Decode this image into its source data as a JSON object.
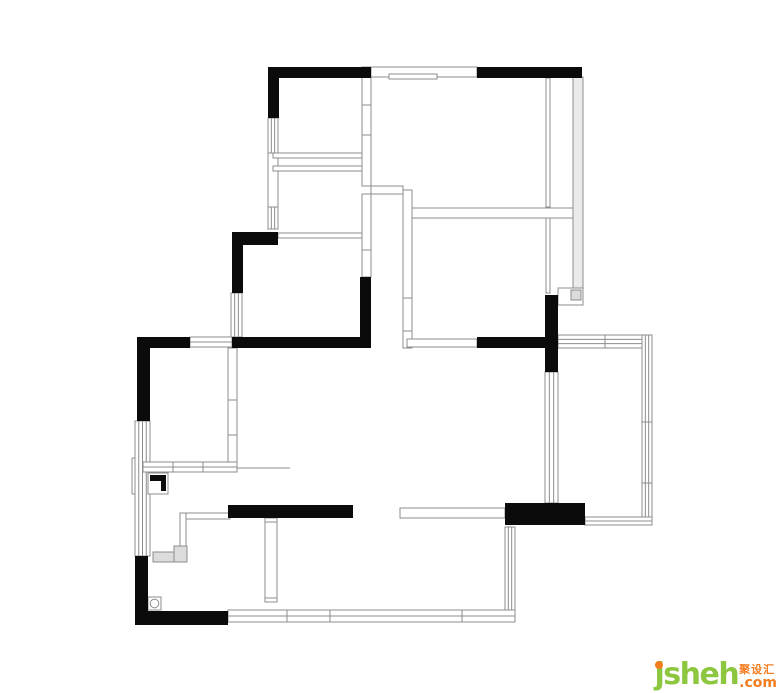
{
  "page": {
    "background": "#ffffff"
  },
  "logo": {
    "brand": "jsheh",
    "cn_label": "聚设汇",
    "tld": ".com",
    "green": "#8dc63f",
    "orange": "#f47d20"
  },
  "floor_plan": {
    "stroke": "#8c8c8c",
    "wall_fill": "#0b0b0b",
    "glass_fill": "#ebebeb",
    "hatch_fill": "#dcdcdc",
    "solid_walls": [
      {
        "x": 268,
        "y": 67,
        "w": 103,
        "h": 11
      },
      {
        "x": 268,
        "y": 67,
        "w": 11,
        "h": 51
      },
      {
        "x": 477,
        "y": 67,
        "w": 105,
        "h": 11
      },
      {
        "x": 232,
        "y": 232,
        "w": 46,
        "h": 13
      },
      {
        "x": 232,
        "y": 232,
        "w": 11,
        "h": 61
      },
      {
        "x": 360,
        "y": 277,
        "w": 11,
        "h": 71
      },
      {
        "x": 232,
        "y": 337,
        "w": 139,
        "h": 11
      },
      {
        "x": 477,
        "y": 337,
        "w": 68,
        "h": 11
      },
      {
        "x": 545,
        "y": 295,
        "w": 13,
        "h": 77
      },
      {
        "x": 137,
        "y": 337,
        "w": 53,
        "h": 11
      },
      {
        "x": 137,
        "y": 337,
        "w": 13,
        "h": 84
      },
      {
        "x": 135,
        "y": 556,
        "w": 13,
        "h": 69
      },
      {
        "x": 135,
        "y": 611,
        "w": 93,
        "h": 14
      },
      {
        "x": 228,
        "y": 505,
        "w": 125,
        "h": 13
      },
      {
        "x": 505,
        "y": 503,
        "w": 80,
        "h": 22
      }
    ],
    "thin_rects": [
      {
        "x": 371,
        "y": 67,
        "w": 106,
        "h": 10
      },
      {
        "x": 389,
        "y": 74,
        "w": 48,
        "h": 5
      },
      {
        "x": 268,
        "y": 153,
        "w": 10,
        "h": 55
      },
      {
        "x": 273,
        "y": 153,
        "w": 92,
        "h": 5
      },
      {
        "x": 273,
        "y": 166,
        "w": 92,
        "h": 5
      },
      {
        "x": 362,
        "y": 67,
        "w": 9,
        "h": 119
      },
      {
        "x": 371,
        "y": 186,
        "w": 32,
        "h": 8
      },
      {
        "x": 362,
        "y": 194,
        "w": 9,
        "h": 83
      },
      {
        "x": 278,
        "y": 233,
        "w": 84,
        "h": 5
      },
      {
        "x": 403,
        "y": 190,
        "w": 9,
        "h": 158
      },
      {
        "x": 412,
        "y": 208,
        "w": 171,
        "h": 10
      },
      {
        "x": 546,
        "y": 78,
        "w": 4,
        "h": 129
      },
      {
        "x": 546,
        "y": 218,
        "w": 4,
        "h": 75
      },
      {
        "x": 573,
        "y": 77,
        "w": 10,
        "h": 218,
        "fill": "glass"
      },
      {
        "x": 558,
        "y": 288,
        "w": 25,
        "h": 17
      },
      {
        "x": 407,
        "y": 339,
        "w": 70,
        "h": 8
      },
      {
        "x": 400,
        "y": 508,
        "w": 105,
        "h": 10
      },
      {
        "x": 228,
        "y": 348,
        "w": 9,
        "h": 124
      },
      {
        "x": 265,
        "y": 518,
        "w": 12,
        "h": 84
      },
      {
        "x": 180,
        "y": 513,
        "w": 50,
        "h": 6
      },
      {
        "x": 180,
        "y": 513,
        "w": 6,
        "h": 43
      },
      {
        "x": 132,
        "y": 458,
        "w": 16,
        "h": 36
      }
    ],
    "window_bands": [
      {
        "x": 268,
        "y": 118,
        "w": 10,
        "h": 35,
        "orient": "v",
        "inner": 2,
        "ticks": []
      },
      {
        "x": 268,
        "y": 207,
        "w": 10,
        "h": 22,
        "orient": "v",
        "inner": 2,
        "ticks": []
      },
      {
        "x": 231,
        "y": 293,
        "w": 11,
        "h": 44,
        "orient": "v",
        "inner": 2,
        "ticks": []
      },
      {
        "x": 190,
        "y": 337,
        "w": 42,
        "h": 10,
        "orient": "h",
        "inner": 1,
        "ticks": []
      },
      {
        "x": 135,
        "y": 421,
        "w": 15,
        "h": 135,
        "orient": "v",
        "inner": 3,
        "ticks": []
      },
      {
        "x": 143,
        "y": 462,
        "w": 94,
        "h": 10,
        "orient": "h",
        "inner": 1,
        "ticks": [
          173,
          203
        ]
      },
      {
        "x": 545,
        "y": 372,
        "w": 13,
        "h": 131,
        "orient": "v",
        "inner": 2,
        "ticks": []
      },
      {
        "x": 558,
        "y": 335,
        "w": 94,
        "h": 13,
        "orient": "h",
        "inner": 2,
        "ticks": [
          605
        ]
      },
      {
        "x": 642,
        "y": 335,
        "w": 10,
        "h": 190,
        "orient": "v",
        "inner": 2,
        "ticks": [
          422,
          483
        ]
      },
      {
        "x": 585,
        "y": 517,
        "w": 67,
        "h": 8,
        "orient": "h",
        "inner": 1,
        "ticks": []
      },
      {
        "x": 505,
        "y": 527,
        "w": 10,
        "h": 93,
        "orient": "v",
        "inner": 2,
        "ticks": []
      },
      {
        "x": 228,
        "y": 610,
        "w": 287,
        "h": 12,
        "orient": "h",
        "inner": 1,
        "ticks": [
          287,
          330,
          462
        ]
      }
    ],
    "lines": [
      {
        "x1": 362,
        "y1": 105,
        "x2": 371,
        "y2": 105
      },
      {
        "x1": 362,
        "y1": 135,
        "x2": 371,
        "y2": 135
      },
      {
        "x1": 362,
        "y1": 250,
        "x2": 371,
        "y2": 250
      },
      {
        "x1": 403,
        "y1": 298,
        "x2": 412,
        "y2": 298
      },
      {
        "x1": 403,
        "y1": 331,
        "x2": 412,
        "y2": 331
      },
      {
        "x1": 228,
        "y1": 400,
        "x2": 237,
        "y2": 400
      },
      {
        "x1": 228,
        "y1": 435,
        "x2": 237,
        "y2": 435
      },
      {
        "x1": 265,
        "y1": 522,
        "x2": 277,
        "y2": 522
      },
      {
        "x1": 265,
        "y1": 598,
        "x2": 277,
        "y2": 598
      },
      {
        "x1": 237,
        "y1": 468,
        "x2": 290,
        "y2": 468
      }
    ],
    "symbols": {
      "flue_square": {
        "x": 571,
        "y": 290,
        "w": 10,
        "h": 10
      },
      "shower_box": {
        "x": 148,
        "y": 473,
        "w": 20,
        "h": 21
      },
      "shower_wedge_points": "150,475 166,475 166,491 161,491 161,481 150,481",
      "hatches": [
        {
          "x": 153,
          "y": 552,
          "w": 30,
          "h": 10
        },
        {
          "x": 174,
          "y": 546,
          "w": 13,
          "h": 16
        }
      ],
      "drain": {
        "x": 148,
        "y": 597,
        "w": 13,
        "h": 13
      }
    }
  }
}
